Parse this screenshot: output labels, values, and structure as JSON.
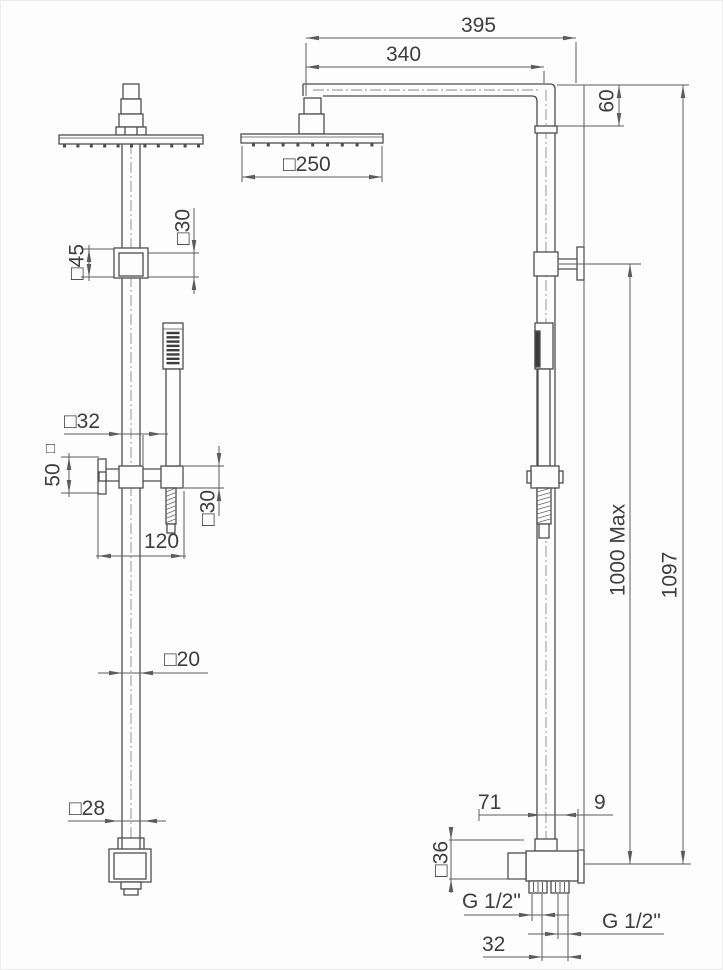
{
  "labels": {
    "overall_width": "395",
    "arm_length": "340",
    "arm_height": "60",
    "head_size": "□250",
    "total_height": "1097",
    "riser_height": "1000 Max",
    "ceiling_bracket": "□45",
    "ceiling_bracket_depth": "□30",
    "slider_offset": "□32",
    "knob_height": "50",
    "knob_square": "□",
    "holder_height": "□30",
    "slider_length": "120",
    "pipe_section": "□20",
    "base_section": "□28",
    "valve_left": "71",
    "valve_right": "9",
    "valve_section": "□36",
    "thread_left": "G 1/2\"",
    "thread_right": "G 1/2\"",
    "thread_spacing": "32"
  }
}
